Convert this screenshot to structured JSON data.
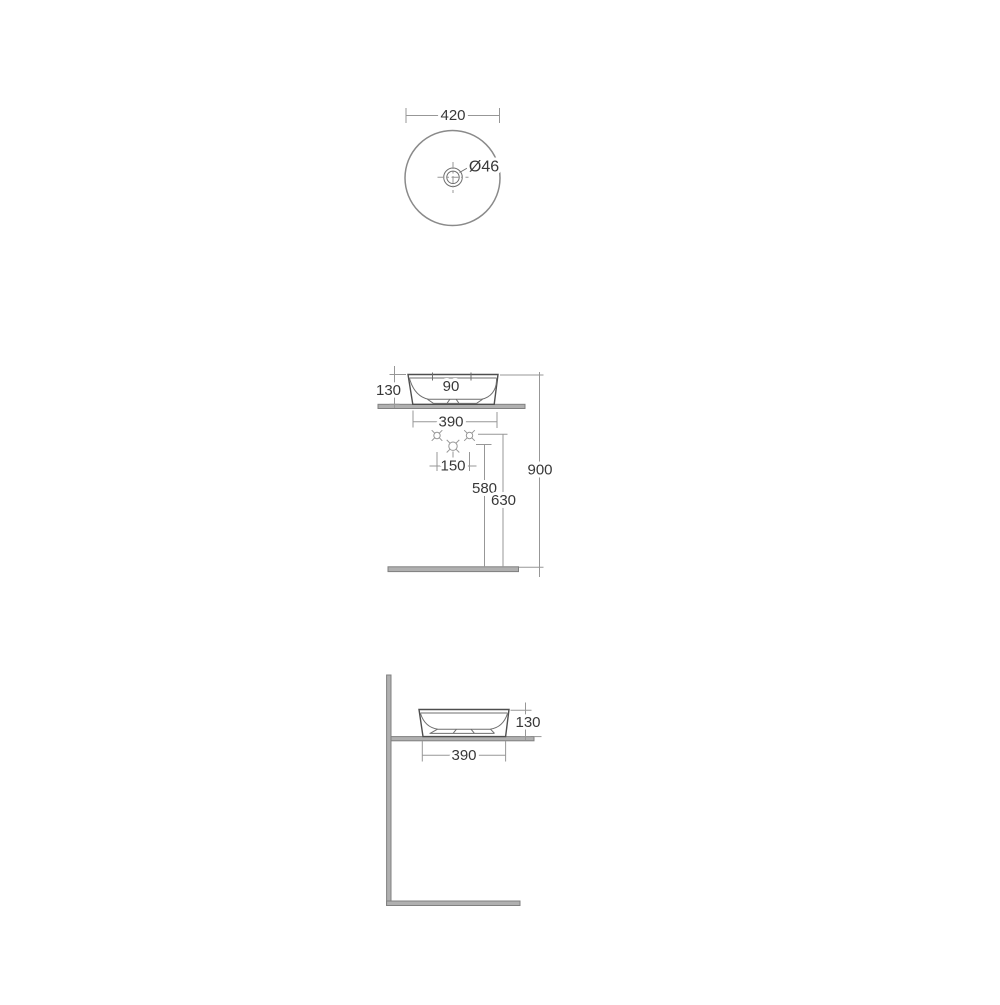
{
  "document": {
    "type": "washbasin-technical-drawing",
    "background": "#ffffff"
  },
  "colors": {
    "outline": "#4e4e4e",
    "rim": "#8a8a8a",
    "dimension_line": "#979797",
    "label_text": "#383838",
    "surface_fill": "#b0b0b0",
    "surface_stroke": "#808080"
  },
  "views": {
    "top": {
      "name": "top-view",
      "labels": {
        "overall_width": "420",
        "drain_diameter": "Ø46"
      }
    },
    "front": {
      "name": "front-view",
      "labels": {
        "basin_height": "130",
        "inner_dim": "90",
        "base_width": "390",
        "hole_spacing": "150",
        "outlet_height": "580",
        "holes_height": "630",
        "rim_height": "900"
      }
    },
    "side": {
      "name": "side-view",
      "labels": {
        "basin_height": "130",
        "base_depth": "390"
      }
    }
  }
}
